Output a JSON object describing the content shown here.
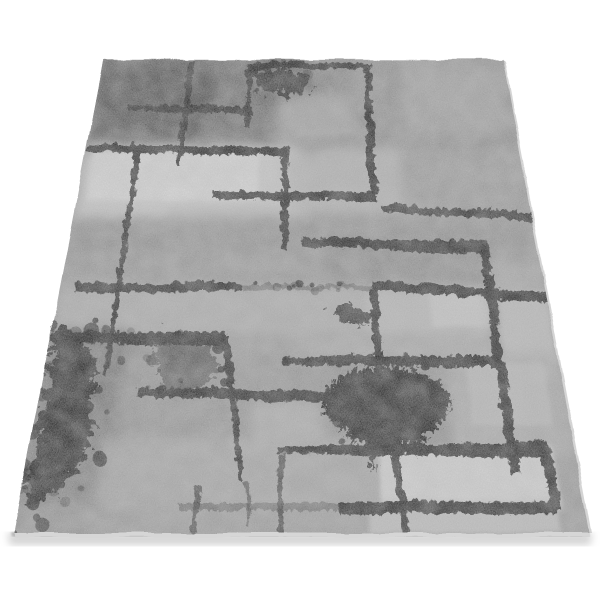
{
  "scene": {
    "background_color": "#ffffff",
    "alt": "Angled product photo of a modern gray abstract area rug with black grunge rectangle outlines, paint splatters and a scrubby tree silhouette"
  },
  "rug": {
    "projection": {
      "wb": 576,
      "wt": 400,
      "vpx": 306,
      "vpy": -1018,
      "cbx": 300,
      "k": 2.691
    },
    "corners_screen": {
      "top_left": [
        102,
        57
      ],
      "top_right": [
        502,
        57
      ],
      "bottom_right": [
        588,
        530
      ],
      "bottom_left": [
        12,
        532
      ]
    },
    "base_color": "#979797",
    "ink_color": "#161616",
    "edge_strip_color": "#d6d6d6",
    "side_sliver_color": "#c9c9c9",
    "shadow_color": "#a8a8a8",
    "shadow_core_color": "#868686",
    "patches": [
      [
        0,
        0,
        52,
        27,
        "#585858",
        1,
        2
      ],
      [
        0,
        0,
        30,
        19,
        "#484848",
        0.9,
        2
      ],
      [
        28,
        0,
        48,
        26,
        "#6c6c6c",
        0.85,
        2
      ],
      [
        44,
        0,
        72,
        26,
        "#7f7f7f",
        0.9,
        2
      ],
      [
        62,
        0,
        100,
        26,
        "#8f8f8f",
        1,
        2
      ],
      [
        74,
        2,
        98,
        21,
        "#a2a2a2",
        0.8,
        2
      ],
      [
        36,
        1,
        52,
        13,
        "#5f5f5f",
        0.8,
        1
      ],
      [
        44,
        10,
        62,
        23,
        "#a6a6a6",
        0.85,
        2
      ],
      [
        0,
        24,
        50,
        43,
        "#c9c9c9",
        1,
        2
      ],
      [
        2,
        26,
        40,
        38,
        "#dadada",
        0.9,
        1
      ],
      [
        46,
        25,
        74,
        41,
        "#b3b3b3",
        0.9,
        2
      ],
      [
        72,
        26,
        100,
        44,
        "#999999",
        0.9,
        2
      ],
      [
        20,
        39,
        46,
        47,
        "#b0b0b0",
        0.6,
        2
      ],
      [
        0,
        42,
        100,
        50,
        "#8e8e8e",
        0.9,
        2
      ],
      [
        0,
        50,
        58,
        58,
        "#959595",
        0.9,
        2
      ],
      [
        55,
        47,
        90,
        58,
        "#898989",
        0.9,
        2
      ],
      [
        0,
        57,
        62,
        67,
        "#acacac",
        0.95,
        2
      ],
      [
        62,
        57,
        88,
        67,
        "#bababa",
        0.9,
        2
      ],
      [
        76,
        58,
        88,
        65,
        "#c9c9c9",
        0.8,
        1
      ],
      [
        88,
        52,
        100,
        74,
        "#a6a6a6",
        0.9,
        2
      ],
      [
        90,
        58,
        100,
        72,
        "#c3c3c3",
        0.7,
        1
      ],
      [
        0,
        67,
        34,
        78,
        "#8f8f8f",
        0.9,
        2
      ],
      [
        34,
        67,
        50,
        78,
        "#9b9b9b",
        0.9,
        2
      ],
      [
        50,
        67,
        88,
        72,
        "#a9a9a9",
        0.9,
        2
      ],
      [
        0,
        66,
        16,
        93,
        "#6e6e6e",
        0.85,
        2
      ],
      [
        16,
        71,
        56,
        88,
        "#929292",
        0.9,
        2
      ],
      [
        40,
        79,
        56,
        88,
        "#b2b2b2",
        0.75,
        2
      ],
      [
        54,
        72,
        80,
        88,
        "#8c8c8c",
        0.9,
        2
      ],
      [
        78,
        70,
        100,
        88,
        "#aaaaaa",
        0.9,
        2
      ],
      [
        82,
        72,
        97,
        83,
        "#bdbdbd",
        0.7,
        1
      ],
      [
        12,
        85,
        65,
        97,
        "#a5a5a5",
        0.9,
        2
      ],
      [
        64,
        86.5,
        96,
        97,
        "#d2d2d2",
        1,
        1
      ],
      [
        0,
        84,
        13,
        100,
        "#7c7c7c",
        0.9,
        2
      ],
      [
        0,
        96,
        100,
        100,
        "#9b9b9b",
        0.8,
        2
      ],
      [
        62,
        96,
        95,
        100,
        "#c6c6c6",
        0.8,
        1
      ]
    ],
    "lines": [
      [
        "h",
        13.4,
        8,
        37.5,
        1.6,
        2.2,
        0.95,
        14.5
      ],
      [
        "h",
        1.3,
        36,
        65.5,
        1.8,
        1.8,
        0.95,
        null
      ],
      [
        "h",
        36,
        29.5,
        66,
        1.9,
        2.2,
        0.95,
        36.4
      ],
      [
        "h",
        24.6,
        0,
        46,
        2.0,
        2.2,
        0.95,
        25.4
      ],
      [
        "h",
        39.3,
        67,
        100,
        1.4,
        2.1,
        0.9,
        41.3
      ],
      [
        "h",
        47,
        49.5,
        88.5,
        1.9,
        3.0,
        0.95,
        48.2
      ],
      [
        "h",
        56.9,
        3,
        37,
        2.0,
        1.6,
        0.92,
        null
      ],
      [
        "h",
        56.8,
        37,
        64,
        1.0,
        0.9,
        0.35,
        null
      ],
      [
        "h",
        56.3,
        64,
        100,
        2.0,
        2.2,
        0.95,
        59
      ],
      [
        "h",
        66.9,
        0,
        34.5,
        2.0,
        2.6,
        0.95,
        null
      ],
      [
        "h",
        71.2,
        46,
        88.6,
        1.5,
        2.2,
        0.93,
        null
      ],
      [
        "h",
        76.8,
        18,
        55.5,
        1.8,
        2.0,
        0.93,
        77.9
      ],
      [
        "h",
        86.8,
        45,
        94.8,
        1.2,
        2.6,
        0.95,
        null
      ],
      [
        "h",
        95.9,
        56.5,
        94.6,
        1.8,
        2.0,
        0.95,
        null
      ],
      [
        "h",
        95.7,
        28,
        57,
        1.1,
        1.3,
        0.4,
        null
      ],
      [
        "v",
        21.6,
        0,
        29.5,
        1.7,
        0.9,
        0.95,
        21
      ],
      [
        "v",
        65.4,
        0.5,
        36,
        1.8,
        1.8,
        0.95,
        null
      ],
      [
        "v",
        36.3,
        1,
        19,
        1.6,
        1.3,
        0.9,
        null
      ],
      [
        "v",
        45.7,
        24,
        49,
        1.7,
        1.5,
        0.93,
        null
      ],
      [
        "v",
        88.3,
        46.5,
        90.7,
        2.0,
        1.8,
        0.95,
        null
      ],
      [
        "v",
        11.5,
        25.5,
        74,
        1.5,
        0.8,
        0.9,
        null
      ],
      [
        "v",
        34.3,
        66.5,
        92,
        1.8,
        0.9,
        0.93,
        39
      ],
      [
        "v",
        39.8,
        92,
        99,
        0.8,
        0.6,
        0.5,
        40.5
      ],
      [
        "v",
        64.4,
        57,
        74,
        1.6,
        1.6,
        0.93,
        null
      ],
      [
        "v",
        94.6,
        86.5,
        96.2,
        1.9,
        1.8,
        0.95,
        null
      ],
      [
        "v",
        66.8,
        87,
        100,
        1.5,
        1.2,
        0.9,
        68
      ],
      [
        "v",
        46,
        87.5,
        100,
        1.1,
        0.9,
        0.7,
        null
      ],
      [
        "v",
        31,
        92.5,
        100,
        1.1,
        0.9,
        0.65,
        null
      ]
    ],
    "splats": [
      {
        "name": "top-ink-blob",
        "f": "splat",
        "op": 0.95,
        "pts": [
          [
            36,
            1
          ],
          [
            43,
            1.5
          ],
          [
            48.5,
            3
          ],
          [
            50.8,
            5.5
          ],
          [
            49.5,
            8
          ],
          [
            45,
            9.2
          ],
          [
            40.5,
            8.5
          ],
          [
            37.5,
            6
          ],
          [
            35.8,
            3
          ]
        ]
      },
      {
        "name": "small-center-blob",
        "f": "splat",
        "op": 0.8,
        "pts": [
          [
            56,
            59.5
          ],
          [
            61,
            59.8
          ],
          [
            64,
            61.5
          ],
          [
            62.5,
            63.8
          ],
          [
            58.5,
            63.8
          ],
          [
            55.5,
            61.8
          ]
        ]
      },
      {
        "name": "left-ink-splat",
        "f": "splat",
        "op": 0.95,
        "pts": [
          [
            0,
            64
          ],
          [
            3.5,
            66
          ],
          [
            7.5,
            69
          ],
          [
            9.8,
            73.5
          ],
          [
            8.2,
            78
          ],
          [
            10.8,
            82.5
          ],
          [
            9.2,
            88
          ],
          [
            6,
            92
          ],
          [
            2.5,
            94.8
          ],
          [
            0,
            95.5
          ]
        ]
      },
      {
        "name": "left-scrub-splotch",
        "f": "splat",
        "op": 0.5,
        "pts": [
          [
            20,
            65
          ],
          [
            26,
            66
          ],
          [
            31,
            68.5
          ],
          [
            32.5,
            72
          ],
          [
            30,
            75.5
          ],
          [
            25,
            76.5
          ],
          [
            21,
            74
          ],
          [
            19.5,
            69.5
          ]
        ]
      },
      {
        "name": "tree-silhouette",
        "f": "tree",
        "op": 0.96,
        "pts": [
          [
            63,
            72.3
          ],
          [
            58.5,
            73.2
          ],
          [
            55,
            75
          ],
          [
            53.2,
            77.5
          ],
          [
            53.8,
            80.3
          ],
          [
            55.5,
            82.5
          ],
          [
            58.5,
            84.2
          ],
          [
            57.8,
            87.8
          ],
          [
            59.6,
            84.9
          ],
          [
            61.5,
            86.3
          ],
          [
            62,
            90
          ],
          [
            63.6,
            86.5
          ],
          [
            66,
            86.6
          ],
          [
            67,
            89.8
          ],
          [
            68.2,
            86
          ],
          [
            70.5,
            85
          ],
          [
            70.8,
            88.3
          ],
          [
            72.3,
            84.3
          ],
          [
            75.2,
            82.3
          ],
          [
            77.3,
            79.5
          ],
          [
            77.8,
            76.8
          ],
          [
            75.5,
            74.5
          ],
          [
            71.5,
            72.8
          ],
          [
            67,
            72
          ]
        ]
      }
    ],
    "speckles": [
      {
        "seed": 7,
        "n": 30,
        "cu": 6,
        "ct": 79,
        "ru": 10,
        "rt": 15,
        "rmax": 1.3
      },
      {
        "seed": 13,
        "n": 20,
        "cu": 65,
        "ct": 80,
        "ru": 14,
        "rt": 8,
        "rmax": 1.1
      },
      {
        "seed": 29,
        "n": 16,
        "cu": 43,
        "ct": 4,
        "ru": 9,
        "rt": 4.5,
        "rmax": 1.2
      },
      {
        "seed": 41,
        "n": 14,
        "cu": 4,
        "ct": 95,
        "ru": 5,
        "rt": 5,
        "rmax": 1.1
      },
      {
        "seed": 55,
        "n": 12,
        "cu": 27,
        "ct": 70,
        "ru": 9,
        "rt": 6,
        "rmax": 1.0
      },
      {
        "seed": 67,
        "n": 10,
        "cu": 50,
        "ct": 57,
        "ru": 13,
        "rt": 1.5,
        "rmax": 0.8
      }
    ]
  }
}
